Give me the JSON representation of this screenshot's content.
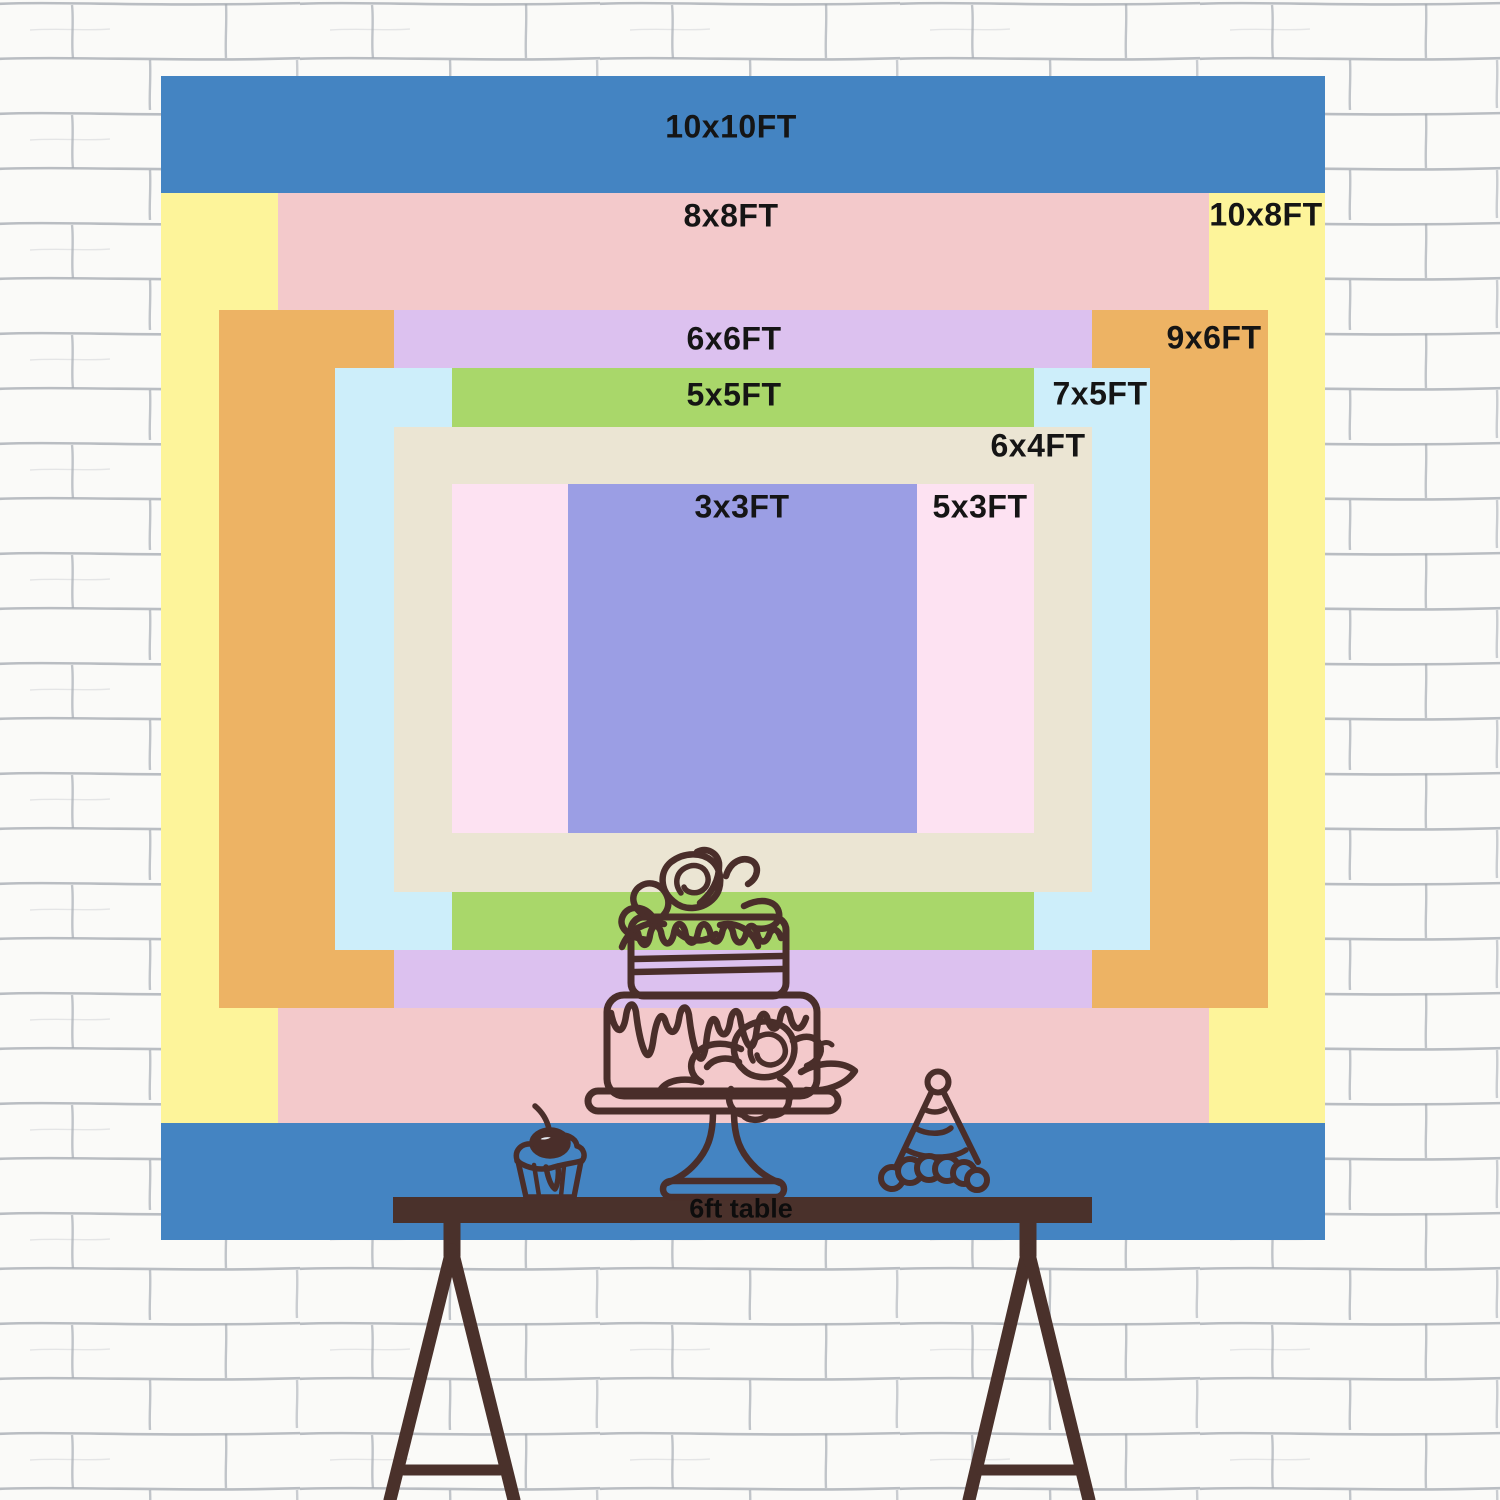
{
  "backdrop_sizes": [
    {
      "label": "10x10FT",
      "color": "#4484c2"
    },
    {
      "label": "10x8FT",
      "color": "#fdf49a"
    },
    {
      "label": "8x8FT",
      "color": "#f3c9cb"
    },
    {
      "label": "9x6FT",
      "color": "#edb364"
    },
    {
      "label": "6x6FT",
      "color": "#dcc1ef"
    },
    {
      "label": "7x5FT",
      "color": "#cdeefa"
    },
    {
      "label": "5x5FT",
      "color": "#a9d76a"
    },
    {
      "label": "6x4FT",
      "color": "#ebe5d3"
    },
    {
      "label": "5x3FT",
      "color": "#fde2f2"
    },
    {
      "label": "3x3FT",
      "color": "#9b9ee4"
    }
  ],
  "table": {
    "label": "6ft table",
    "wood_color": "#4a312b"
  },
  "illustration": {
    "line_color": "#4a2e2a",
    "cherry_highlight": "#e9edf4",
    "items": [
      "tiered-cake-icon",
      "cupcake-icon",
      "party-hat-icon"
    ]
  },
  "wall": {
    "base_color": "#fafaf8",
    "mortar_line_color": "#a2a8b0"
  }
}
